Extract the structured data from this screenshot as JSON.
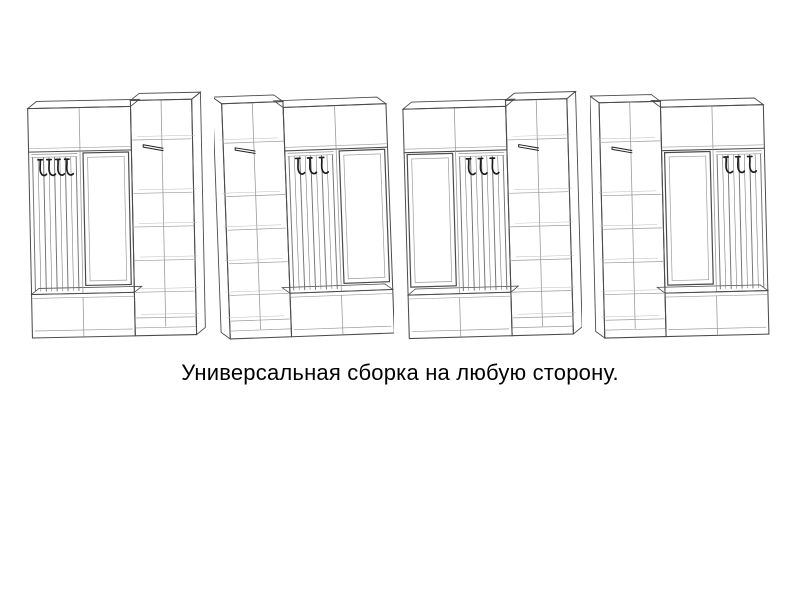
{
  "page": {
    "background": "#ffffff"
  },
  "caption": {
    "text": "Универсальная сборка на любую сторону."
  },
  "drawing": {
    "line_color": "#4a4a4a",
    "light_line_color": "#9a9a9a",
    "back_line_color": "#bcbcbc",
    "slat_color": "#6f6f6f",
    "hook_color": "#1c1c1c"
  },
  "figures": [
    {
      "id": "variant-1",
      "description": "прихожая: крючки слева, зеркало в центре, шкаф справа",
      "arrangement": [
        "hooks",
        "mirror",
        "wardrobe"
      ],
      "hooks_count": 4,
      "perspective": "right",
      "tilt_deg": -1.2
    },
    {
      "id": "variant-2",
      "description": "прихожая: шкаф слева, крючки в центре, зеркало справа",
      "arrangement": [
        "wardrobe",
        "hooks",
        "mirror"
      ],
      "hooks_count": 3,
      "perspective": "left",
      "tilt_deg": -2.1
    },
    {
      "id": "variant-3",
      "description": "прихожая: зеркало слева, крючки в центре, шкаф справа",
      "arrangement": [
        "mirror",
        "hooks",
        "wardrobe"
      ],
      "hooks_count": 3,
      "perspective": "right",
      "tilt_deg": -1.6
    },
    {
      "id": "variant-4",
      "description": "прихожая: шкаф слева, зеркало в центре, крючки справа",
      "arrangement": [
        "wardrobe",
        "mirror",
        "hooks"
      ],
      "hooks_count": 3,
      "perspective": "left",
      "tilt_deg": -1.4
    }
  ]
}
